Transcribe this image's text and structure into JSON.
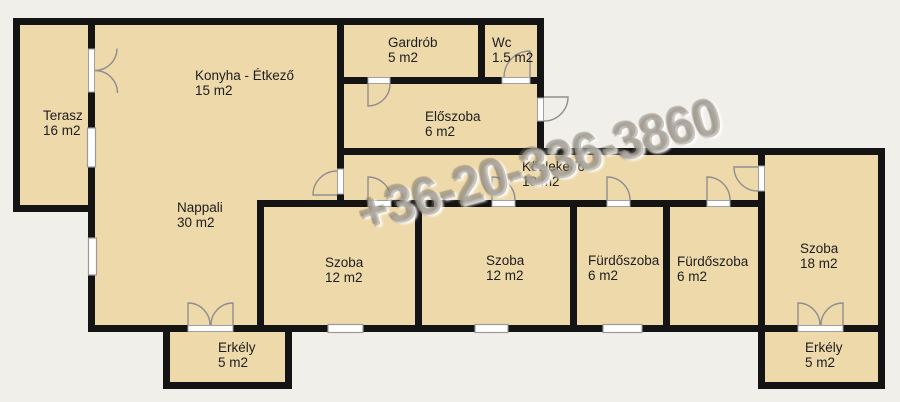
{
  "watermark": {
    "text": "+36-20-336-3860"
  },
  "palette": {
    "wall": "#141414",
    "room_fill": "#eed9ab",
    "background": "#f1efe9",
    "door_stroke": "#8f8f8f",
    "window_fill": "#ffffff",
    "label_color": "#1d1d1d"
  },
  "rooms": [
    {
      "id": "terasz",
      "name": "Terasz",
      "area": "16 m2"
    },
    {
      "id": "konyha",
      "name": "Konyha - Étkező",
      "area": "15 m2"
    },
    {
      "id": "gardrob",
      "name": "Gardrób",
      "area": "5 m2"
    },
    {
      "id": "wc",
      "name": "Wc",
      "area": "1.5 m2"
    },
    {
      "id": "eloszoba",
      "name": "Előszoba",
      "area": "6 m2"
    },
    {
      "id": "kozlekedo",
      "name": "Közlekedő",
      "area": "10 m2"
    },
    {
      "id": "nappali",
      "name": "Nappali",
      "area": "30 m2"
    },
    {
      "id": "szoba1",
      "name": "Szoba",
      "area": "12 m2"
    },
    {
      "id": "szoba2",
      "name": "Szoba",
      "area": "12 m2"
    },
    {
      "id": "furdoszoba1",
      "name": "Fürdőszoba",
      "area": "6 m2"
    },
    {
      "id": "furdoszoba2",
      "name": "Fürdőszoba",
      "area": "6 m2"
    },
    {
      "id": "szoba18",
      "name": "Szoba",
      "area": "18 m2"
    },
    {
      "id": "erkely1",
      "name": "Erkély",
      "area": "5 m2"
    },
    {
      "id": "erkely2",
      "name": "Erkély",
      "area": "5 m2"
    }
  ]
}
